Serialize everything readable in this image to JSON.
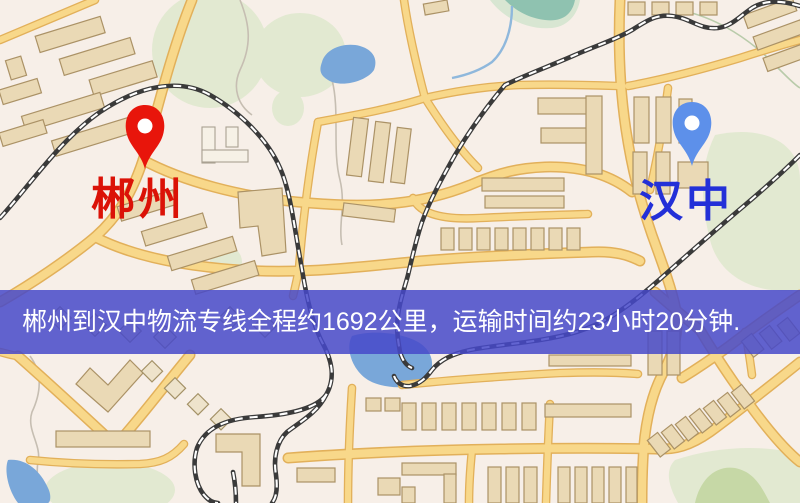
{
  "map": {
    "markers": {
      "origin": {
        "label": "郴州"
      },
      "destination": {
        "label": "汉中"
      }
    },
    "banner": {
      "text": "郴州到汉中物流专线全程约1692公里，运输时间约23小时20分钟."
    },
    "route": {
      "origin": "郴州",
      "destination": "汉中",
      "distance_text": "约1692公里",
      "duration_text": "约23小时20分钟"
    }
  },
  "colors": {
    "map-bg": "#f7efe8",
    "road-fill": "#f8d88a",
    "road-casing": "#e2b05a",
    "water": "#79a7d9",
    "park": "#e2e9d1",
    "park-dark": "#c6d8a6",
    "building": "#ead9b5",
    "rail": "#3a3a3a",
    "banner-bg": "#4649c9",
    "banner-text": "#ffffff",
    "origin-pin": "#e8150b",
    "origin-text": "#db1207",
    "destination-pin": "#5d90ea",
    "destination-text": "#2330d8",
    "pin-hole": "#ffffff"
  }
}
